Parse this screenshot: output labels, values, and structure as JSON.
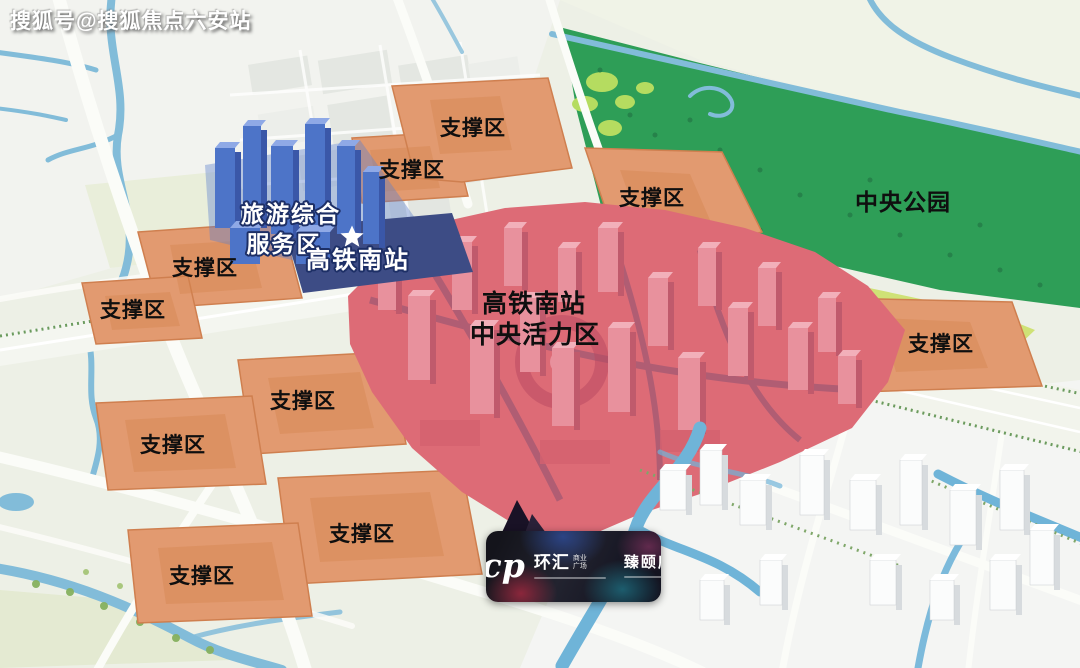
{
  "watermark": "搜狐号@搜狐焦点六安站",
  "labels": {
    "support_zone": "支撑区",
    "central_park": "中央公园",
    "tourism_line1": "旅游综合",
    "tourism_line2": "服务区",
    "station": "高铁南站",
    "vitality_line1": "高铁南站",
    "vitality_line2": "中央活力区"
  },
  "colors": {
    "support_zone": "#e29a70",
    "tourism_service_buildings": "#4d74c8",
    "station_plaza": "#3d4c85",
    "central_vitality": "#dd6b76",
    "central_park": "#2e9e57",
    "park_meadow": "#cfe276",
    "water": "#82bcd9"
  },
  "logo": {
    "brand_short": "icp",
    "brand_name": "环汇",
    "brand_type_line1": "商业",
    "brand_type_line2": "广场",
    "project_name": "臻颐府"
  }
}
